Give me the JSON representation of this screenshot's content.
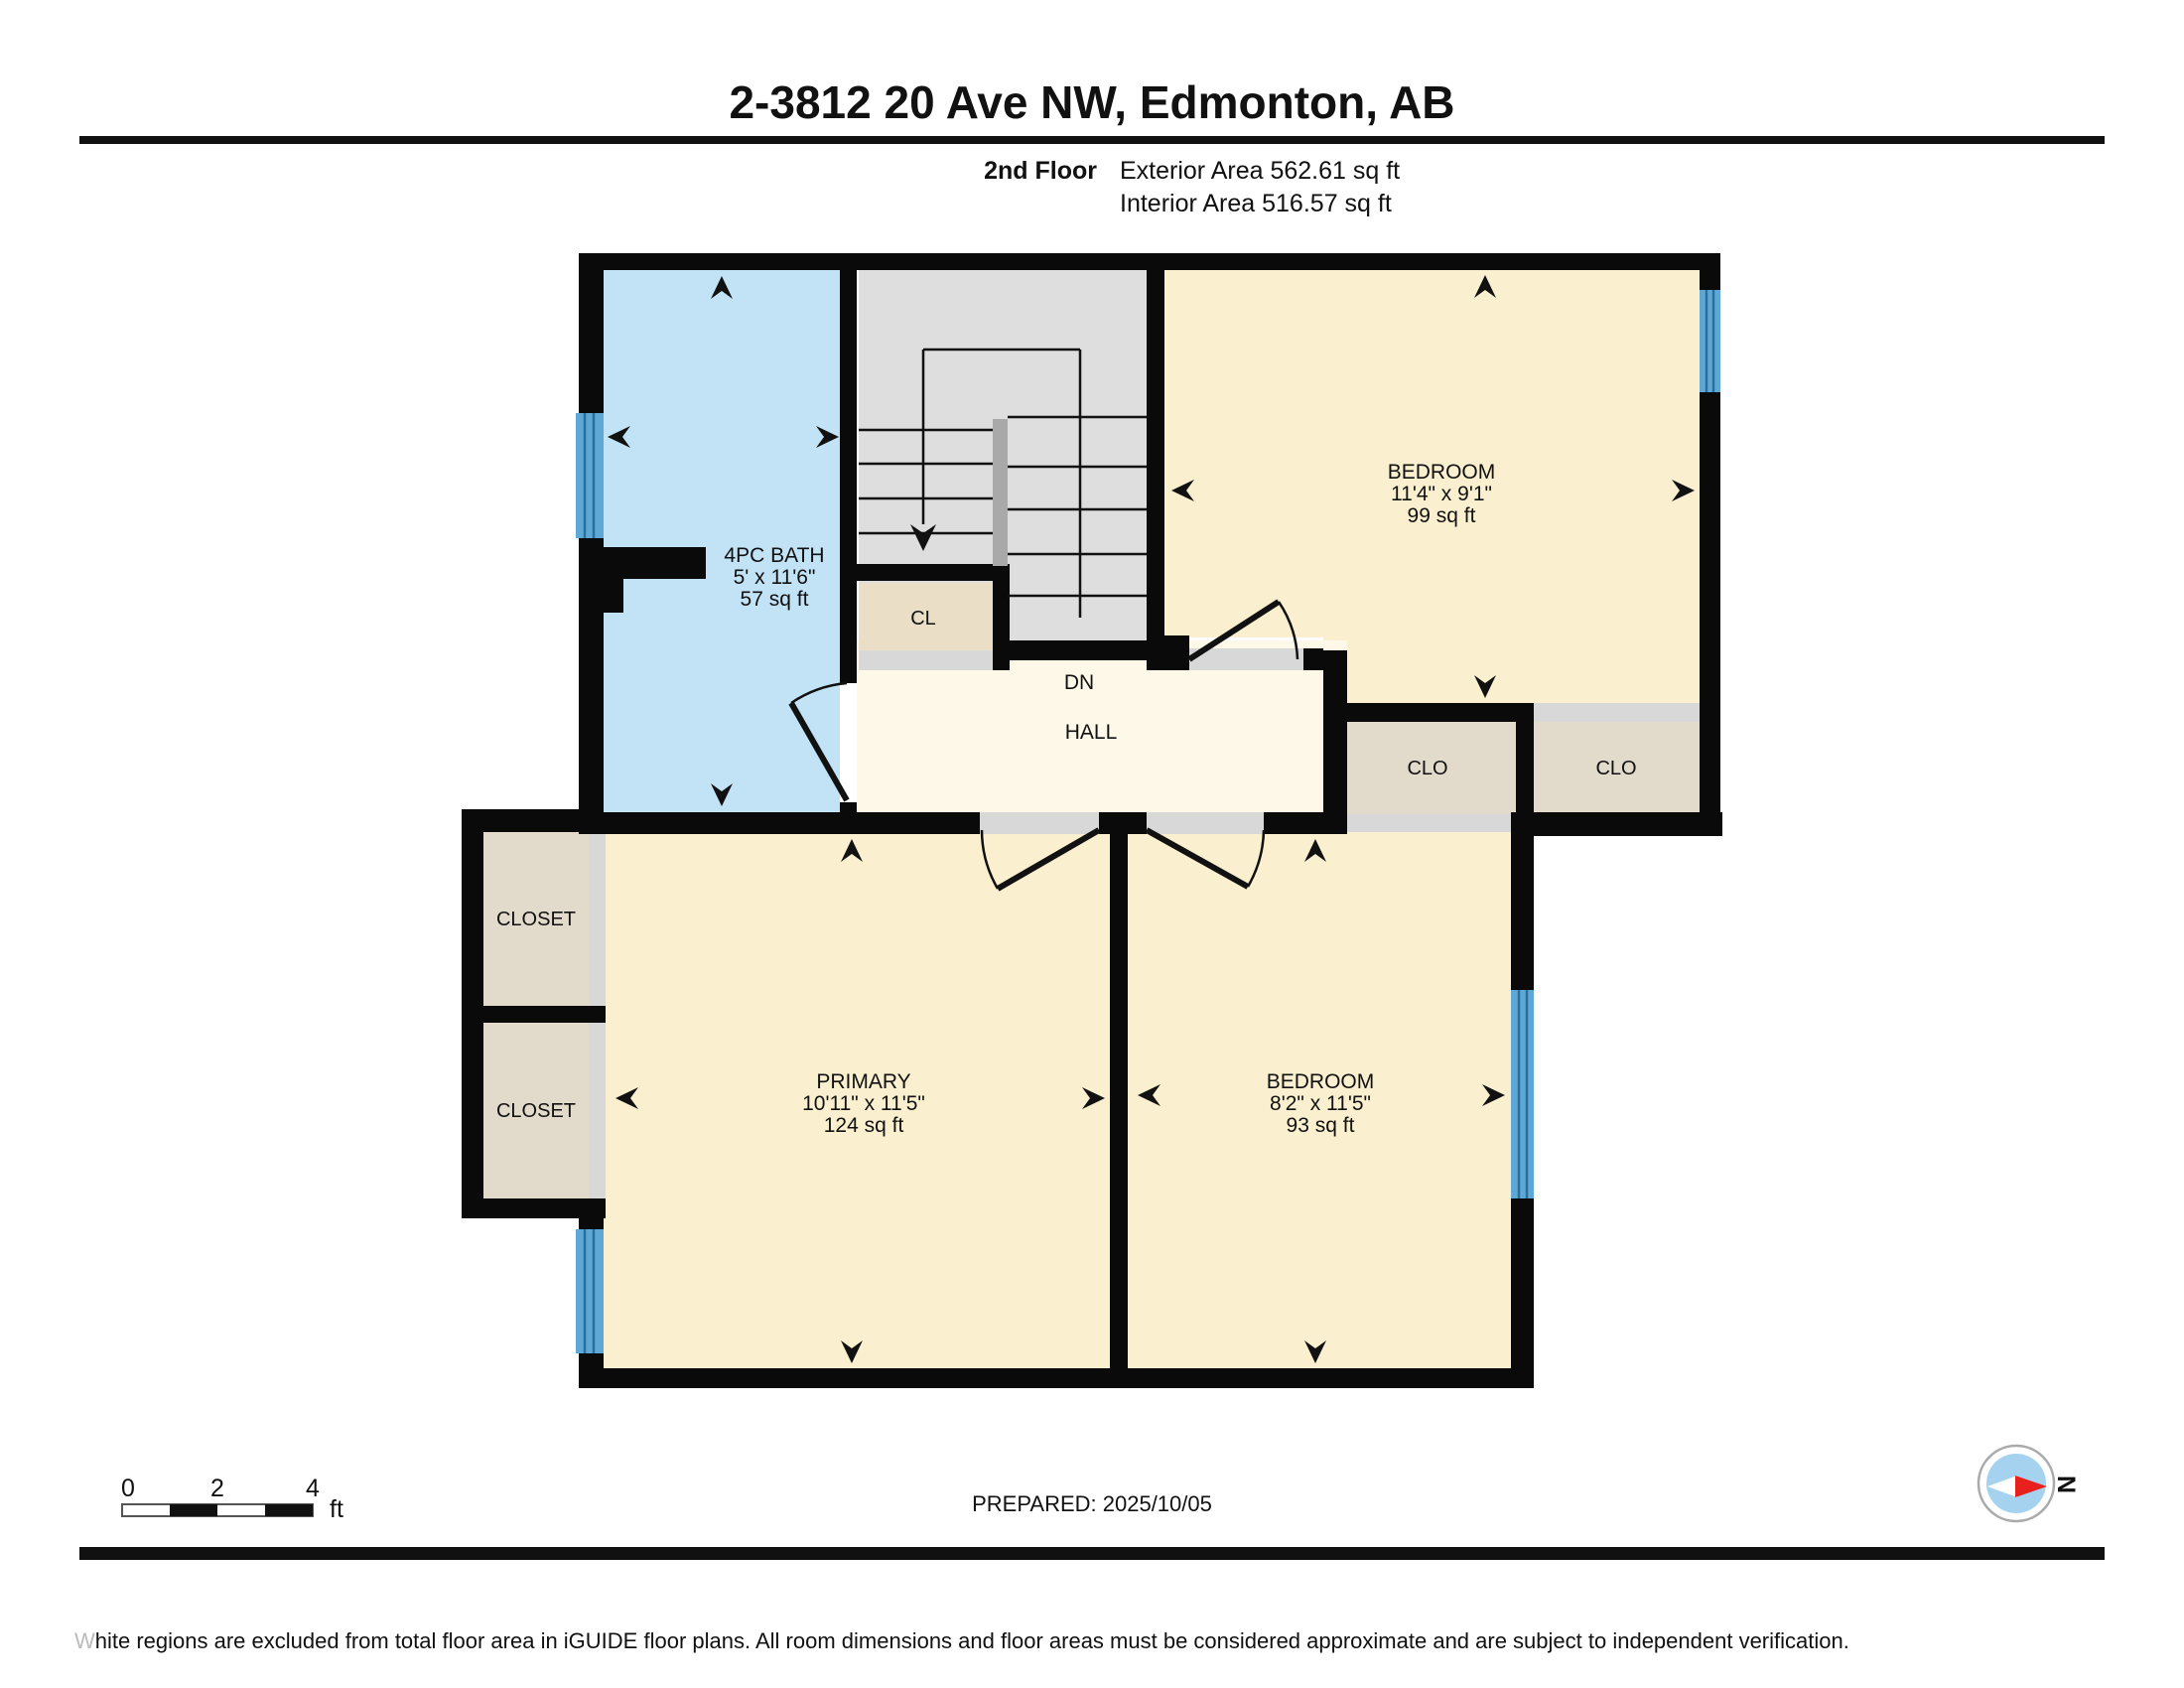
{
  "header": {
    "title": "2-3812 20 Ave NW, Edmonton, AB",
    "floor_label": "2nd Floor",
    "exterior_area": "Exterior Area 562.61 sq ft",
    "interior_area": "Interior Area 516.57 sq ft"
  },
  "rooms": {
    "bath": {
      "name": "4PC BATH",
      "dims": "5' x 11'6\"",
      "area": "57 sq ft"
    },
    "bedroom_top": {
      "name": "BEDROOM",
      "dims": "11'4\" x 9'1\"",
      "area": "99 sq ft"
    },
    "primary": {
      "name": "PRIMARY",
      "dims": "10'11\" x 11'5\"",
      "area": "124 sq ft"
    },
    "bedroom_bottom": {
      "name": "BEDROOM",
      "dims": "8'2\" x 11'5\"",
      "area": "93 sq ft"
    },
    "hall": {
      "name": "HALL",
      "stair_label": "DN"
    },
    "cl": "CL",
    "clo_left": "CLO",
    "clo_right": "CLO",
    "closet_top": "CLOSET",
    "closet_bottom": "CLOSET"
  },
  "scale_bar": {
    "tick0": "0",
    "tick2": "2",
    "tick4": "4",
    "unit": "ft"
  },
  "compass": {
    "north_label": "N"
  },
  "footer": {
    "prepared": "PREPARED: 2025/10/05",
    "disclaimer_lead": "W",
    "disclaimer_rest": "hite regions are excluded from total floor area in iGUIDE floor plans. All room dimensions and floor areas must be considered approximate and are subject to independent verification."
  },
  "colors": {
    "wall": "#0a0a0a",
    "bath": "#C2E3F6",
    "room": "#FAF0CF",
    "hall": "#FDF8E8",
    "closet": "#E2DACA",
    "cl_closet": "#EADFC6",
    "stairs": "#DEDEDE",
    "stair_rail": "#A9A9A9",
    "sill": "#D8D8D8",
    "window_glass": "#5FA8D5",
    "compass_blue": "#A5D2EE",
    "compass_red": "#E8211D"
  }
}
